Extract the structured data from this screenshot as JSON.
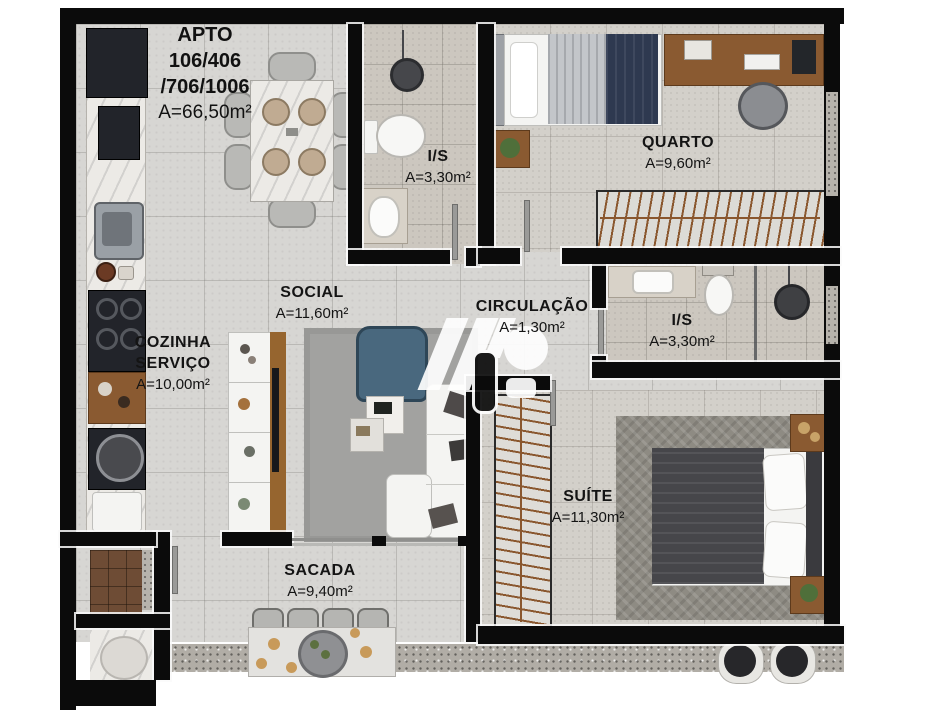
{
  "title_block": {
    "line1": "APTO",
    "line2": "106/406",
    "line3": "/706/1006",
    "area": "A=66,50m²"
  },
  "rooms": {
    "is_top": {
      "name": "I/S",
      "area": "A=3,30m²"
    },
    "quarto": {
      "name": "QUARTO",
      "area": "A=9,60m²"
    },
    "social": {
      "name": "SOCIAL",
      "area": "A=11,60m²"
    },
    "circulacao": {
      "name": "CIRCULAÇÃO",
      "area": "A=1,30m²"
    },
    "is_mid": {
      "name": "I/S",
      "area": "A=3,30m²"
    },
    "cozinha": {
      "name": "COZINHA",
      "name2": "SERVIÇO",
      "area": "A=10,00m²"
    },
    "suite": {
      "name": "SUÍTE",
      "area": "A=11,30m²"
    },
    "sacada": {
      "name": "SACADA",
      "area": "A=9,40m²"
    }
  },
  "colors": {
    "wall": "#0b0b0b",
    "floor": "#d7d6d3",
    "wood": "#8a5a31",
    "navy_blanket": "#2e3950",
    "suite_blanket": "#46464a",
    "armchair_blue": "#49687e",
    "granite": "#b1ada6"
  }
}
